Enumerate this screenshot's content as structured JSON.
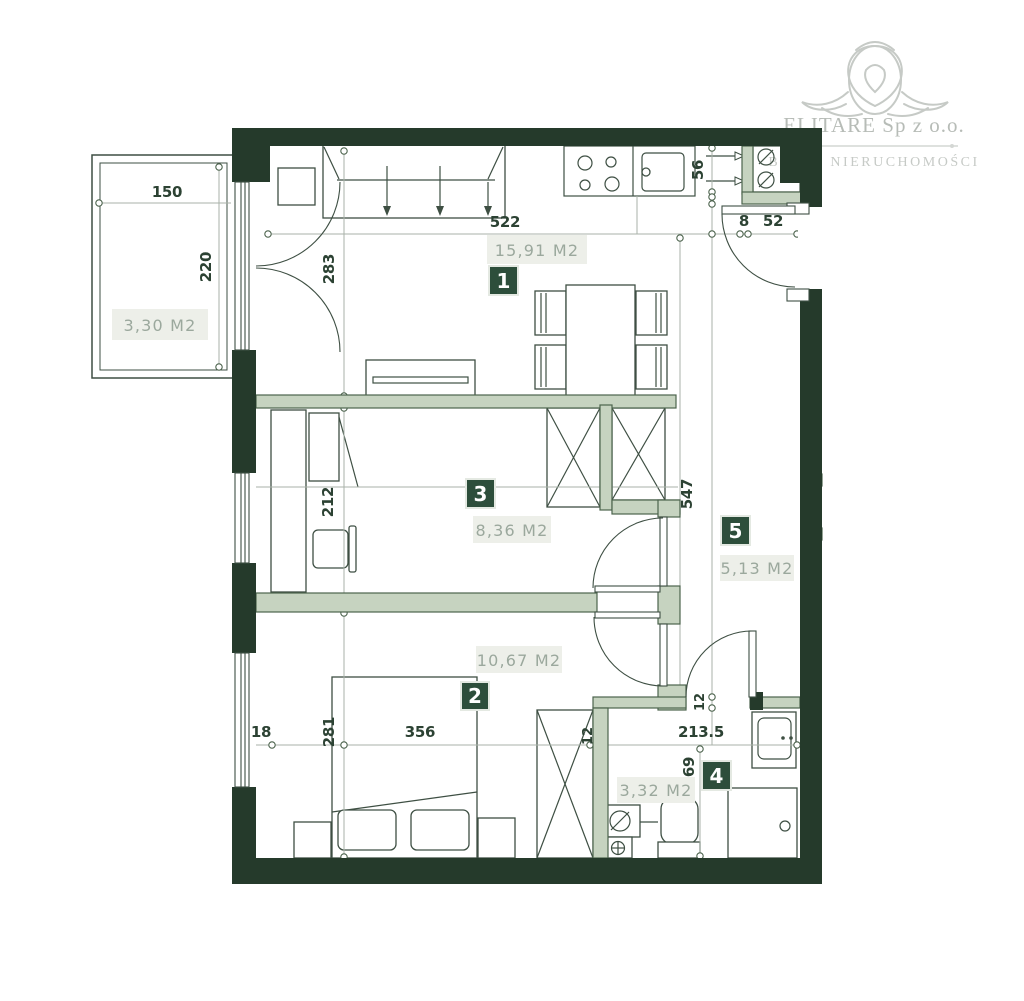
{
  "colors": {
    "wall_dark": "#253a2b",
    "wall_light": "#c6d3c0",
    "wall_edge": "#4c634d",
    "line": "#3e4f43",
    "ref": "#a8b2a8",
    "dim": "#2c4233",
    "accent": "#2d4e3b",
    "label": "#9ba89d",
    "labelbg": "#edefe9",
    "logo": "#b7bcb7",
    "logo2": "#c6cac6"
  },
  "logo": {
    "company": "ELITARE Sp z o.o.",
    "subtitle": "BIURO NIERUCHOMOŚCI"
  },
  "rooms": {
    "living": {
      "badge": "1",
      "area": "15,91 M2"
    },
    "bedroom": {
      "badge": "2",
      "area": "10,67 M2"
    },
    "bedroom2": {
      "badge": "3",
      "area": "8,36 M2"
    },
    "bathroom": {
      "badge": "4",
      "area": "3,32 M2"
    },
    "hall": {
      "badge": "5",
      "area": "5,13 M2"
    },
    "balcony": {
      "area": "3,30 M2"
    }
  },
  "dims": {
    "balcony_w": "150",
    "balcony_d": "220",
    "living_w": "522",
    "balcony_door": "283",
    "niche_h": "56",
    "entry_off": "8",
    "entry_w": "52",
    "bed2_h": "212",
    "hall_l": "547",
    "win_off": "18",
    "bed_h": "281",
    "bed_w": "356",
    "wall_a": "12",
    "bath_w": "213.5",
    "bath_h": "169",
    "wall_b": "12"
  }
}
